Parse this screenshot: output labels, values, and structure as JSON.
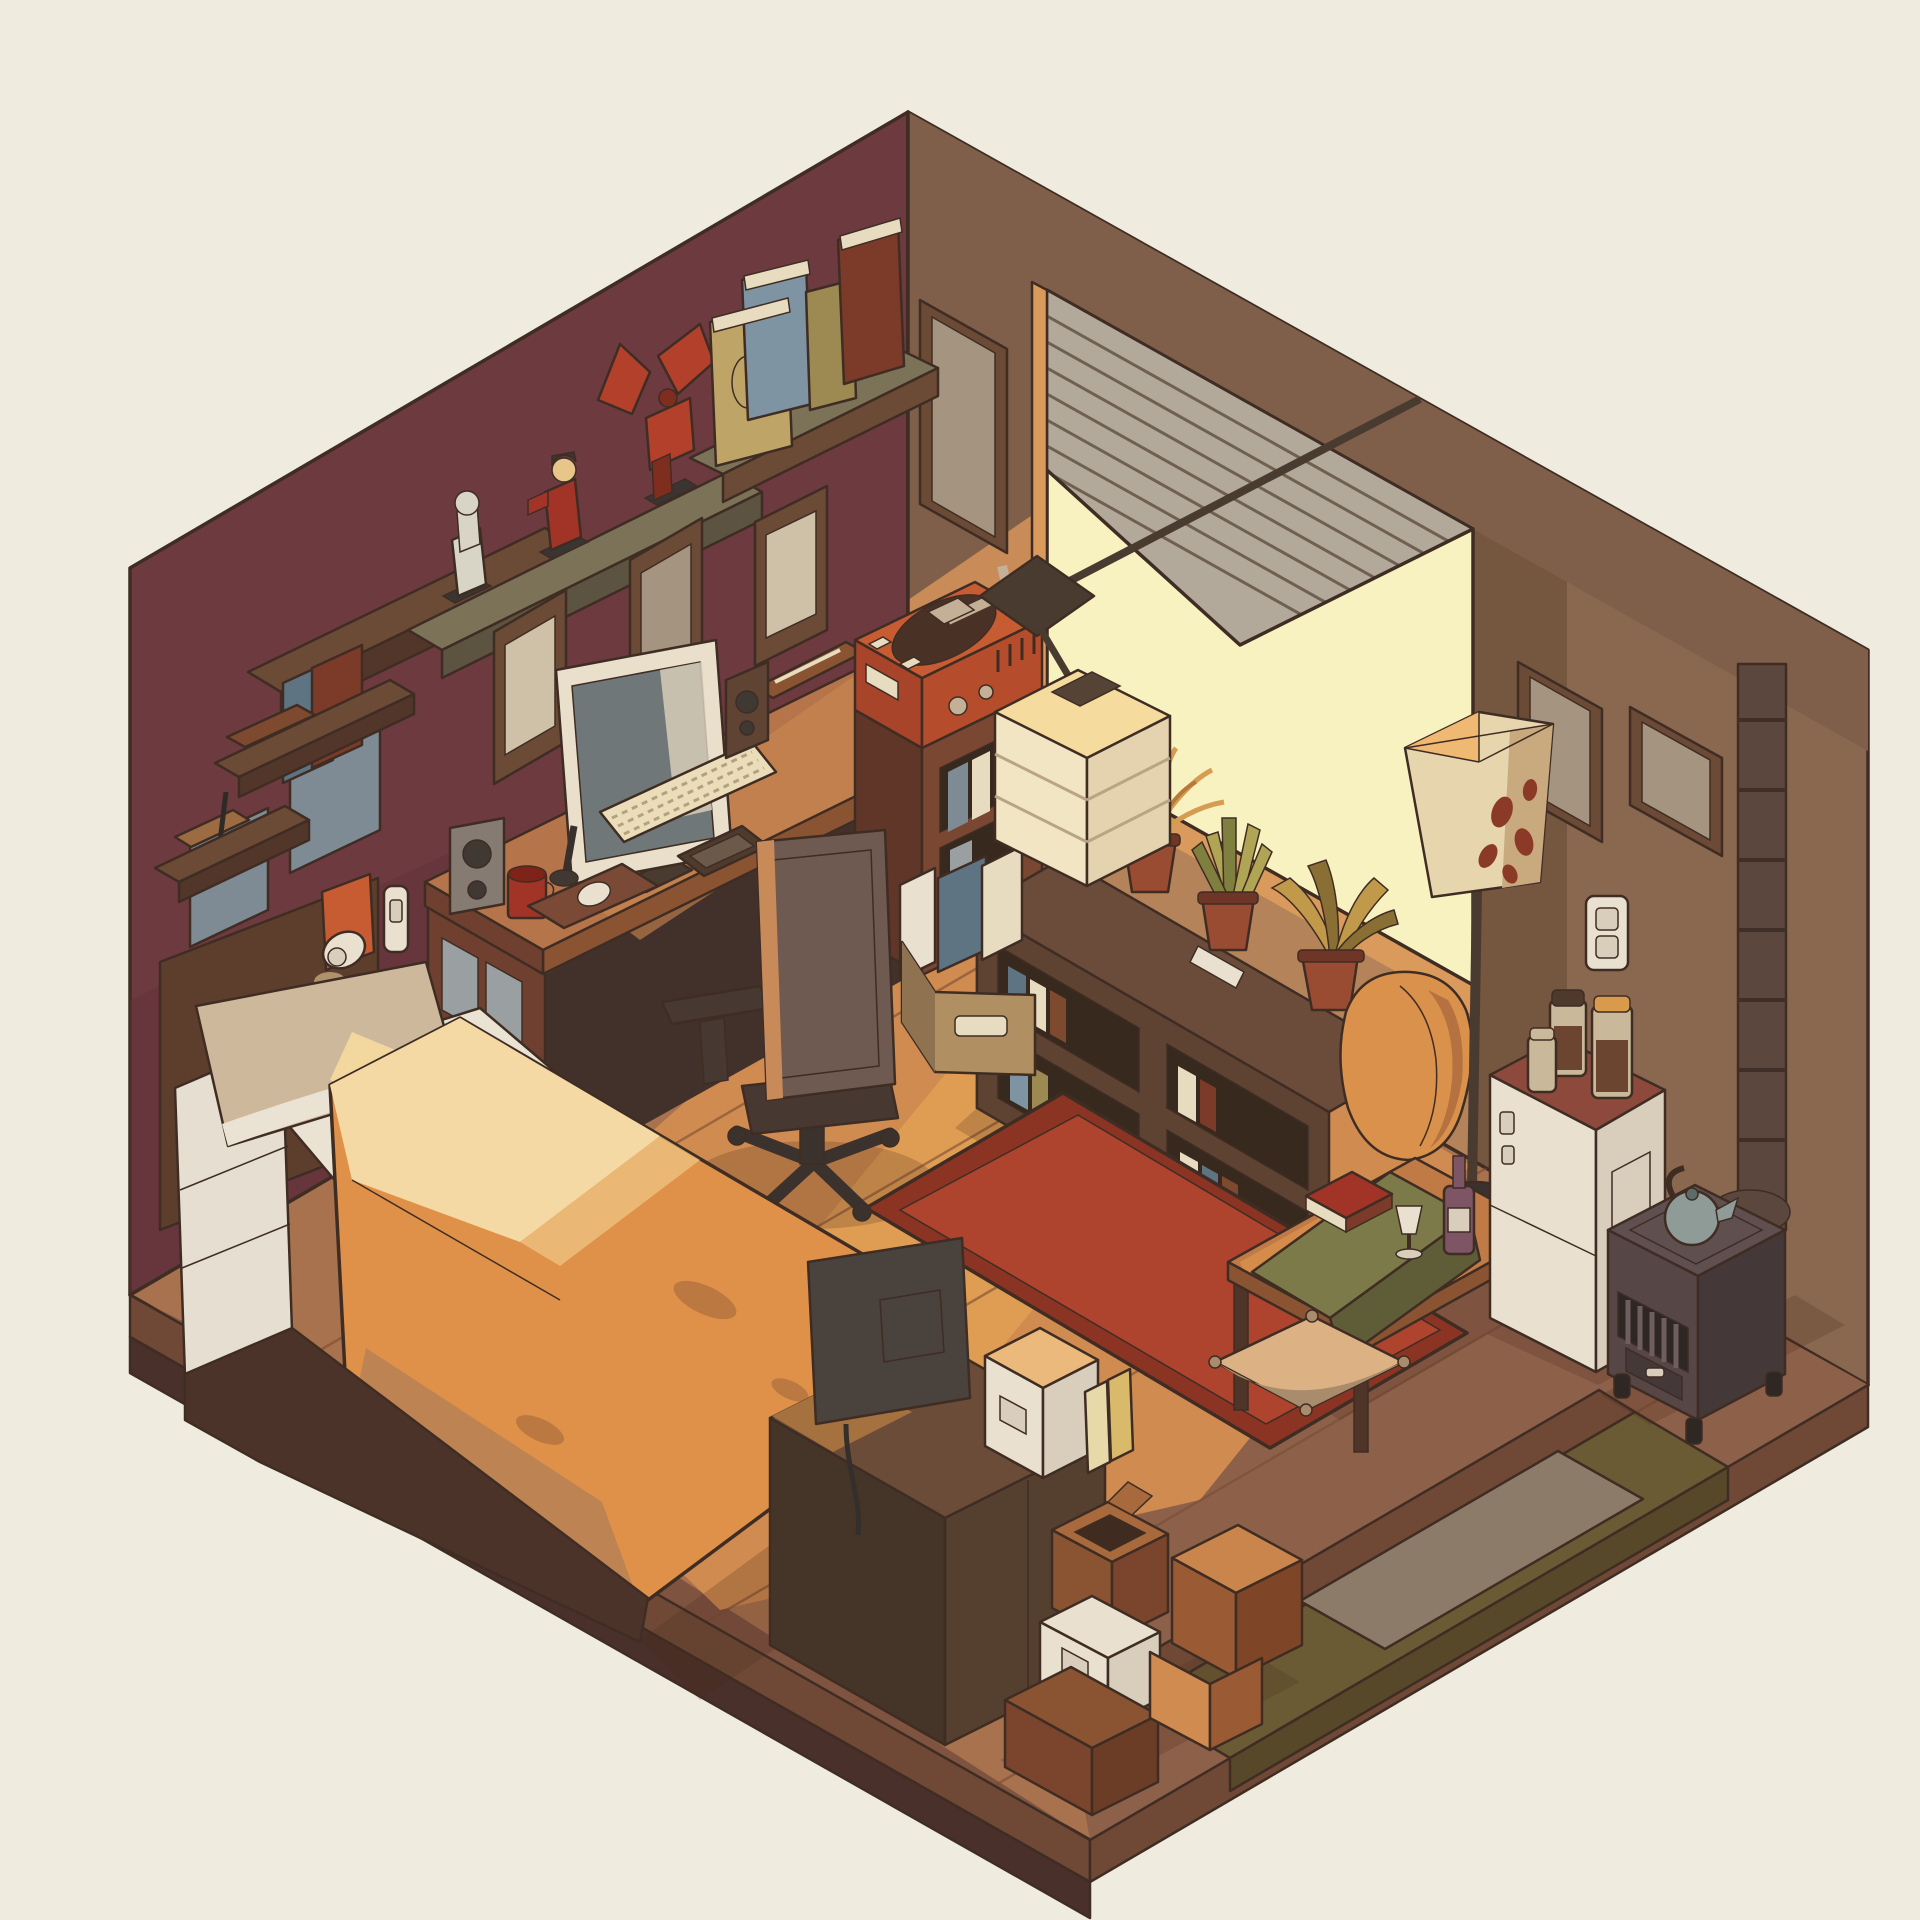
{
  "scene": {
    "description": "Isometric flat-style illustration of a cozy single-room interior at golden hour: maroon left wall and brown right wall, sunlight pouring through a window with crooked venetian blinds onto a wooden floor.",
    "objects": [
      "left-wall",
      "right-wall",
      "floor",
      "window",
      "venetian-blinds",
      "hanging-cube-lamp",
      "wall-shelf-books",
      "figurine-shelf",
      "white-figurine",
      "red-figurine",
      "winged-robot-figurine",
      "picture-frames",
      "small-wall-shelves",
      "incense-shelf",
      "desk",
      "monitor",
      "keyboard",
      "mouse",
      "mousepad",
      "microphone",
      "red-mug",
      "left-speaker",
      "right-speaker",
      "smartphone",
      "pencil-tray",
      "office-chair",
      "record-player",
      "media-cabinet",
      "magazine-slots",
      "low-bookshelf",
      "dry-potted-plant",
      "snake-plant",
      "golden-plant",
      "throw-blanket",
      "remote-control",
      "file-box",
      "floor-lamp",
      "fridge",
      "jars",
      "wood-stove",
      "kettle",
      "stove-chimney",
      "coffee-table",
      "table-runner",
      "red-book",
      "wine-bottle",
      "wine-glass",
      "red-rug",
      "floor-cushion",
      "bed",
      "headboard",
      "reading-sconce",
      "light-switch",
      "pillow",
      "white-sheet",
      "orange-duvet",
      "tv-back",
      "tv-cabinet",
      "white-storage-box",
      "shelf-books",
      "open-cardboard-box",
      "small-white-box",
      "cardboard-boxes",
      "entry-platform",
      "doormat",
      "sunbeam"
    ]
  },
  "palette": {
    "bg": "#f0ebdf",
    "ink": "#3f2d24",
    "wall_left": "#6d3a40",
    "wall_left_dark": "#5f3137",
    "wall_right": "#8a6850",
    "wall_right_dark": "#7f5f49",
    "wall_band_dark": "#75573f",
    "wall_lit": "#c98c58",
    "wall_lit_low": "#b5835a",
    "sill_lit": "#d99a5c",
    "window_glow": "#f8f1c0",
    "blinds": "#b3a99a",
    "blind_line": "#6f6052",
    "floor": "#a8724e",
    "floor_lit": "#cf8b50",
    "floor_beam": "#e2a055",
    "floor_dark": "#8d604a",
    "floor_darker": "#7e5340",
    "slab_side": "#6f4936",
    "slab_side_dark": "#49302a",
    "entry_olive": "#6b5b34",
    "entry_olive_dark": "#57482a",
    "doormat": "#8d7b6a",
    "rug_main": "#ae432e",
    "rug_border": "#8b3424",
    "shadow": "#4a2a1d",
    "shelf_olive": "#7c7257",
    "shelf_olive_side": "#5c5340",
    "shelf_brown": "#6b4a36",
    "shelf_brown_side": "#52362a",
    "book_tan": "#bfa468",
    "book_blue": "#7f94a2",
    "book_olive": "#9c8a52",
    "book_red": "#7c3a28",
    "book_brown": "#7e4a2f",
    "book_slate": "#5f7482",
    "pages": "#e8dcc0",
    "figure_white": "#d8d4c6",
    "figure_red": "#a23427",
    "figure_skin": "#e8c68a",
    "figure_hair": "#3a3432",
    "robot_red": "#b2402a",
    "robot_dark": "#7e2d1f",
    "cloth_slate": "#7e8b94",
    "wood_light": "#9c6b42",
    "frame_wood": "#6b4a36",
    "frame_inner": "#a5947f",
    "frame_inner2": "#cfc0a8",
    "headboard": "#5d3e2d",
    "sconce_pad": "#c75c32",
    "white": "#e9e0cf",
    "white_dim": "#d9cdbb",
    "desk_top": "#b5744a",
    "desk_top_lit": "#cd8953",
    "desk_front": "#6f4030",
    "desk_dark": "#4a3328",
    "under_desk": "#42302a",
    "panel_gray": "#9aa0a2",
    "monitor_bezel": "#e9dfcb",
    "screen": "#6f7779",
    "screen_sheen": "#d8cdb9",
    "keyboard": "#ecddba",
    "key_line": "#b3a27f",
    "phone": "#4f3a2e",
    "phone_screen": "#6b5a4a",
    "mousepad": "#7a4a36",
    "mug": "#a23427",
    "mug_dark": "#7e2318",
    "speaker_gray": "#857b72",
    "speaker_dark": "#3f3833",
    "speaker_brown": "#5f4434",
    "chair_body": "#6e5a50",
    "chair_dark": "#473831",
    "chair_lit": "#c98a5a",
    "chair_base": "#3b322d",
    "player_top": "#c75c32",
    "player_front": "#a8442a",
    "player_side": "#b54d2c",
    "platter": "#4a3126",
    "tonearm": "#c4b096",
    "cab_front": "#7a4733",
    "cab_side": "#5f3627",
    "cab_hole": "#38291f",
    "pendant_dark": "#4a3b31",
    "cube_top": "#f6db9f",
    "cube_left": "#f2e5c4",
    "cube_right": "#e4d3ae",
    "cube_line": "#b9a584",
    "cube_hole": "#554436",
    "bshelf_front": "#5f4332",
    "bshelf_top": "#6b4c3a",
    "bshelf_side": "#4a3328",
    "pot": "#9a4c33",
    "pot_dark": "#6f3526",
    "plant_dry": "#d69c52",
    "plant_dry2": "#b5793a",
    "plant_green": "#b0a455",
    "plant_green2": "#7f7f3f",
    "plant_gold": "#c09a4a",
    "plant_gold2": "#8a6f35",
    "blanket": "#d9914c",
    "blanket_dark": "#b5713f",
    "filebox": "#b08f63",
    "filebox_side": "#8f7350",
    "lamp_shade": "#e7d5ae",
    "lamp_shade_lit": "#efb873",
    "lamp_shade_dim": "#c9a97e",
    "lamp_spot": "#8c3a28",
    "fridge_top": "#8c493c",
    "fridge_front": "#e9e0d0",
    "fridge_side": "#d9cdbb",
    "jar_glass": "#c9b99a",
    "jar_content": "#6b4530",
    "jar_lid": "#4f382c",
    "jar_lid_orange": "#d99a4c",
    "stove_top": "#5f4f4f",
    "stove_front": "#564646",
    "stove_side": "#453838",
    "stove_grill": "#2f2723",
    "kettle": "#8e9b96",
    "kettle_dark": "#5f6b66",
    "chimney": "#5b473e",
    "chimney_ring": "#3f2f28",
    "table_top": "#c07a45",
    "table_lit": "#d9914c",
    "table_edge": "#8a5432",
    "table_leg": "#4f3428",
    "runner": "#7c7a49",
    "runner_dark": "#5f5d38",
    "bottle": "#7e5565",
    "cushion": "#dcb184",
    "cushion_dark": "#a98c6b",
    "pillow": "#cdb89c",
    "pillow_lit": "#f2d79e",
    "sheet": "#eae2d2",
    "duvet": "#df914a",
    "duvet_lit": "#f4d9a4",
    "duvet_mid": "#ecc27e",
    "duvet_patch": "#b5743f",
    "duvet_side": "#bd8352",
    "mattress": "#e6ded0",
    "bed_base": "#4c332a",
    "tv": "#4a423c",
    "tv_dark": "#352f2b",
    "tvcab_top": "#6b4c38",
    "tvcab_left": "#453428",
    "tvcab_right": "#55402f",
    "tvcab_lit": "#a5713f",
    "box_top_lit": "#ecb97c",
    "box_brown": "#8a5432",
    "box_brown_dark": "#7a452c",
    "box_brown_side": "#6b3d26",
    "box_flap": "#a86a3d",
    "box_hole": "#3f2b1f",
    "box_orange_top": "#c9854c",
    "box_orange": "#9a5a34",
    "box_orange_side": "#7e4526",
    "book_cream": "#e8d9a8",
    "book_yellow": "#d9b96a"
  }
}
